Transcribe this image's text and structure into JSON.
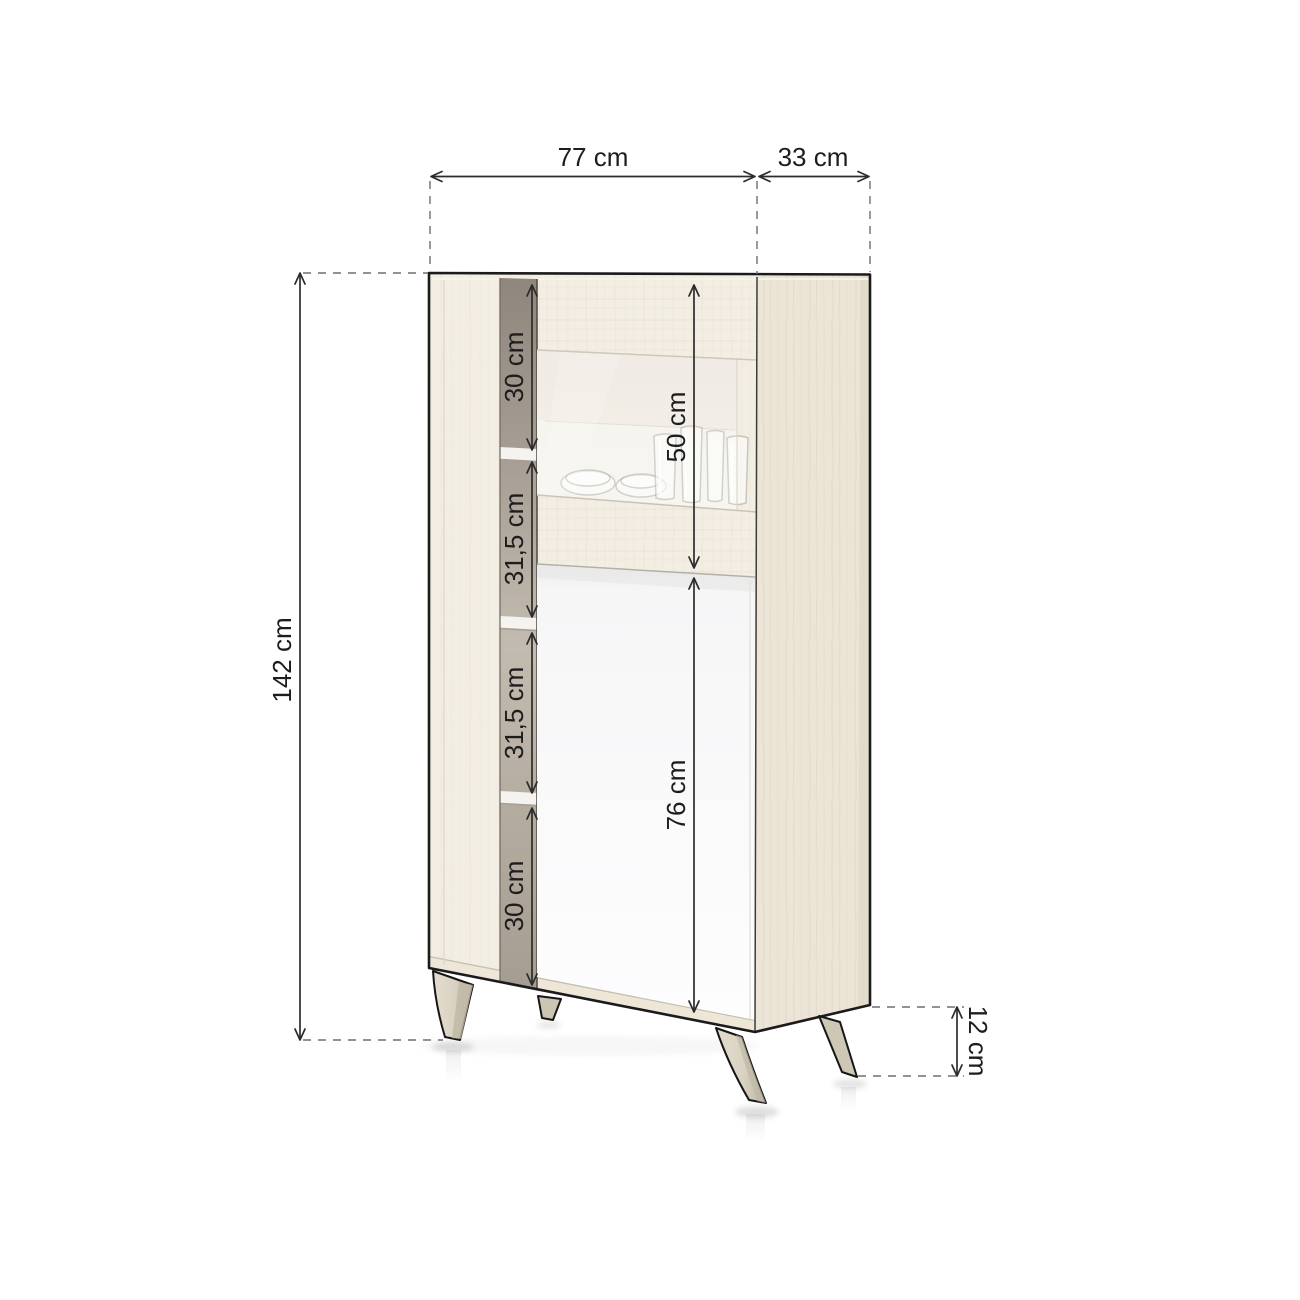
{
  "diagram": {
    "kind": "furniture-dimension-diagram",
    "labels": {
      "width": "77 cm",
      "depth": "33 cm",
      "height": "142 cm",
      "section_top": "30 cm",
      "section_upper_mid": "31,5 cm",
      "section_lower_mid": "31,5 cm",
      "section_bottom": "30 cm",
      "glass_compartment": "50 cm",
      "door_compartment": "76 cm",
      "leg_height": "12 cm"
    },
    "colors": {
      "background": "#ffffff",
      "outline": "#1b1b1b",
      "dimension_line": "#2c2c2c",
      "dashed_line": "#6e6e6e",
      "wood_front": "#f3eee3",
      "wood_side": "#ece4d6",
      "interior_shadow_dark": "#8f867d",
      "interior_shadow_light": "#c2bbb0",
      "door_white": "#fcfcfd",
      "leg_fill": "#dcd5c7"
    }
  }
}
